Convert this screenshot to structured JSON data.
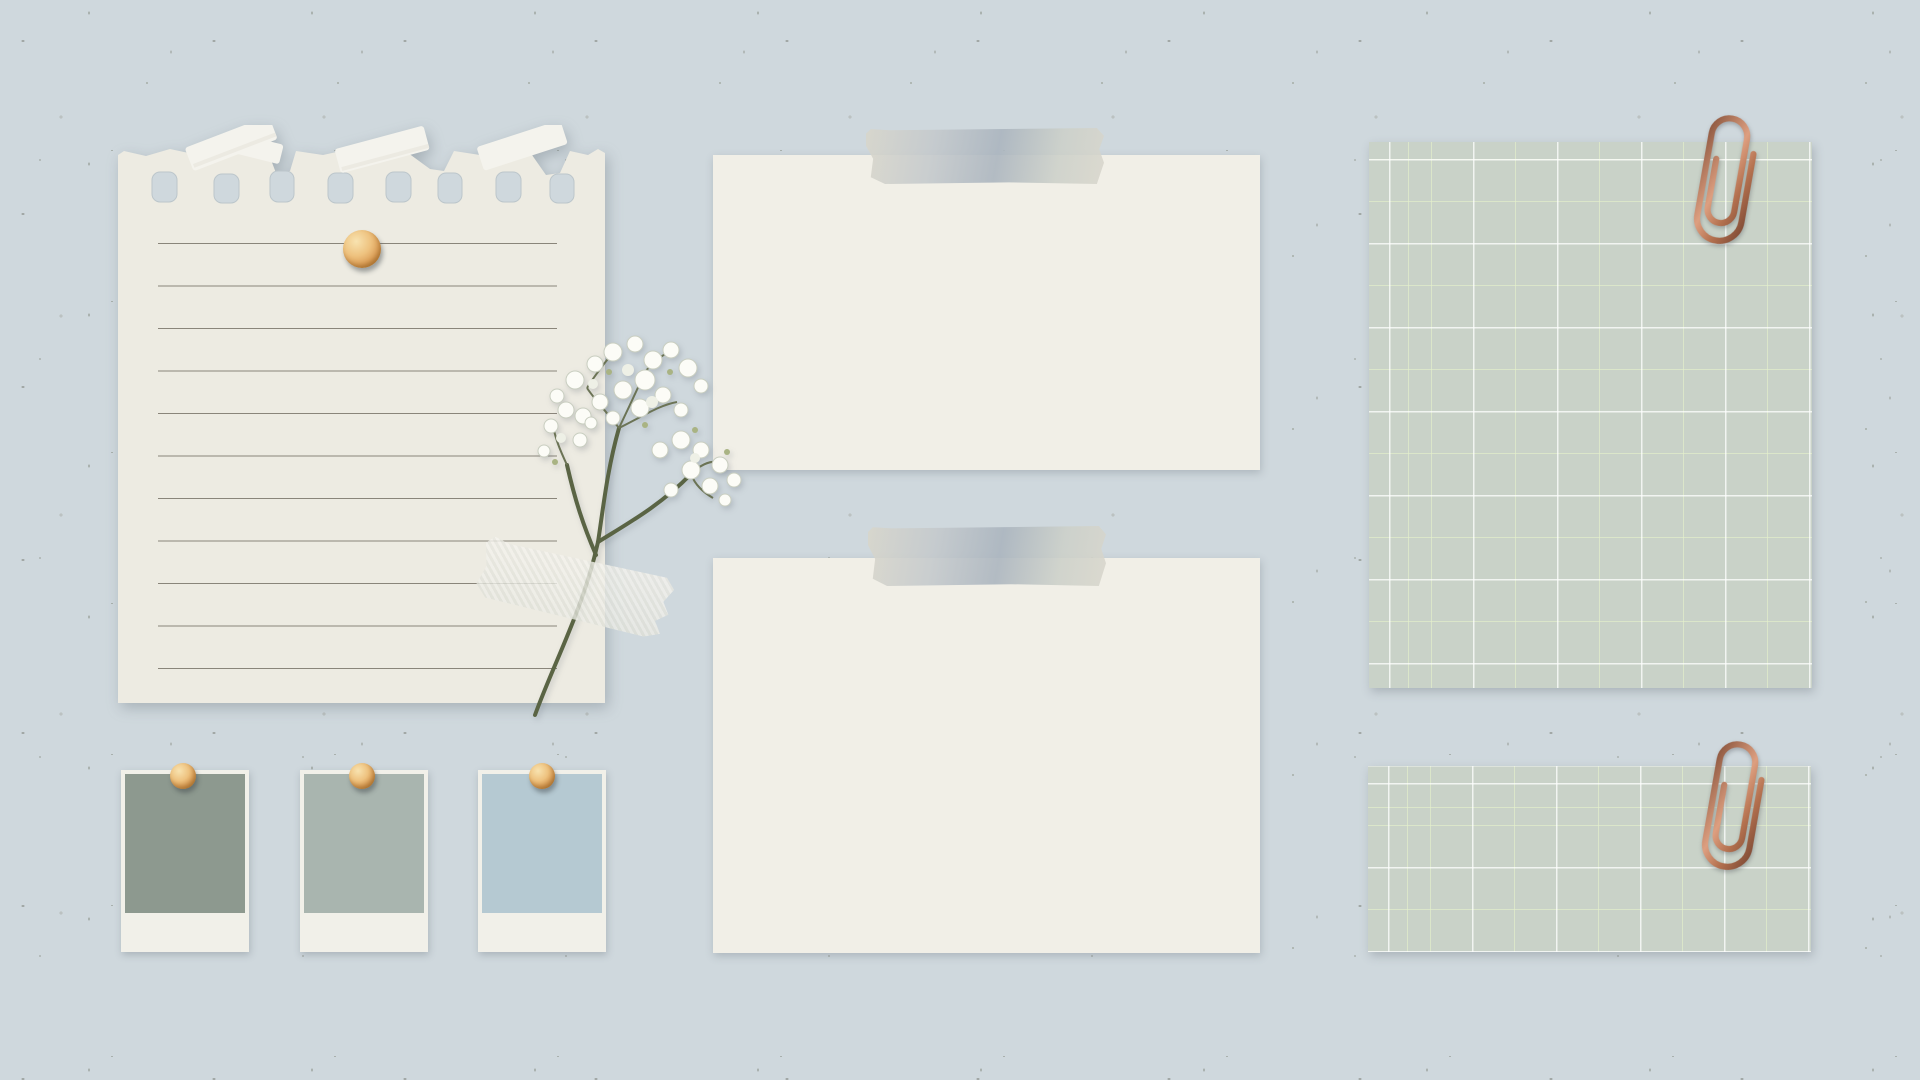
{
  "title": "paper moodboard collage",
  "background": {
    "base_color": "#cfd8dd",
    "speckle_color": "#8f958c"
  },
  "colors": {
    "background": "#cfd8dd",
    "notebook_paper": "#edebe2",
    "notebook_line": "#78736a",
    "card_paper": "#f1efe7",
    "tape_gray": "#c3c8c9",
    "washi_white": "#eae9e1",
    "grid_paper": "#c9d2c8",
    "grid_line_white": "#ffffff",
    "grid_line_accent": "#e5f1cb",
    "paperclip_copper": "#b4714f",
    "pin_gold": "#e8b878",
    "polaroid_frame": "#f1f0e9",
    "swatch_1": "#8d998f",
    "swatch_2": "#a9b5af",
    "swatch_3": "#b5c9d2",
    "flower_blossom": "#fcfcf7",
    "flower_stem": "#5a6444"
  },
  "notebook_note": {
    "ruled_line_count": 11,
    "punched_hole_count": 8,
    "pin": "gold round pin"
  },
  "note_cards": [
    {
      "description": "blank note card with gray tape at top",
      "tape_position": "top-right"
    },
    {
      "description": "blank note card with gray tape at top",
      "tape_position": "top-right"
    }
  ],
  "grid_notes": [
    {
      "description": "large sage grid paper with copper paperclip top-right"
    },
    {
      "description": "small sage grid paper strip with copper paperclip top-right"
    }
  ],
  "color_swatches": [
    {
      "label": "sage-green",
      "color": "#8d998f"
    },
    {
      "label": "gray-green",
      "color": "#a9b5af"
    },
    {
      "label": "powder-blue",
      "color": "#b5c9d2"
    }
  ],
  "flower": {
    "kind": "babys breath sprig"
  }
}
